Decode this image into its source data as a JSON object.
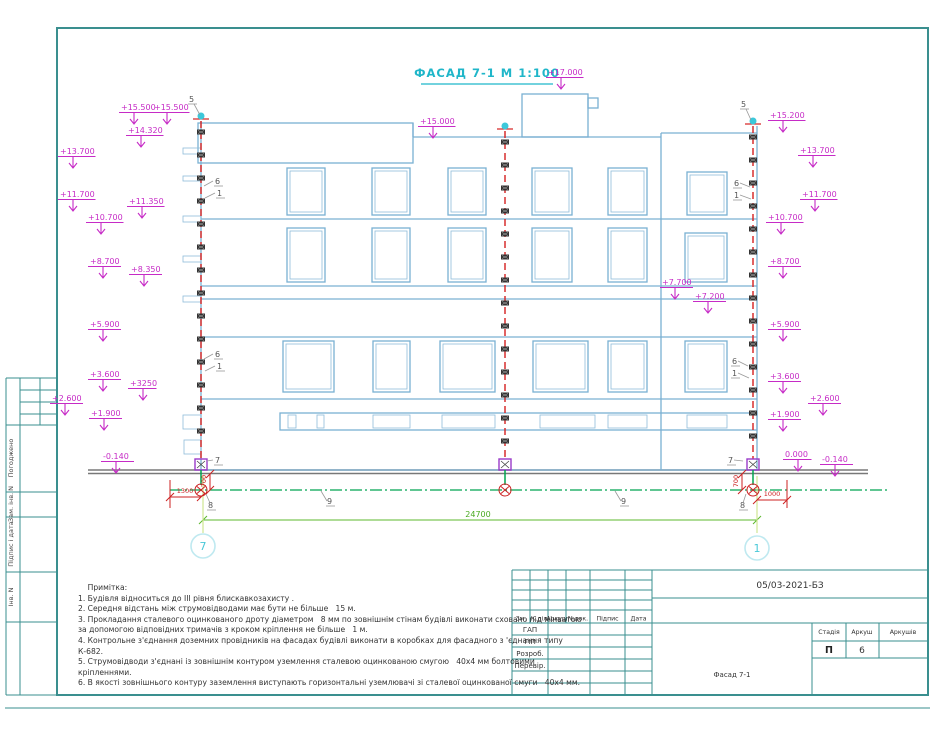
{
  "header": {
    "title": "ФАСАД 7-1  М 1:100"
  },
  "axes": {
    "left": "7",
    "right": "1"
  },
  "dimensions": {
    "total_label": "24700"
  },
  "sheet": {
    "doc_number": "05/03-2021-БЗ",
    "drawing_name": "Фасад 7-1",
    "stage_label": "Стадія",
    "stage_value": "П",
    "sheet_label": "Аркуш",
    "sheet_value": "6",
    "sheets_label": "Аркушів",
    "sheets_value": "",
    "stamp_header": [
      "Зм.",
      "К.діл",
      "Аркуш",
      "№док.",
      "Підпис",
      "Дата"
    ],
    "stamp_rows": [
      "ГАП",
      "ГІП",
      "Розроб.",
      "Перевір."
    ],
    "side_labels": [
      "Погоджено",
      "Зам. інв. N",
      "Підпис і дата",
      "Інв. N"
    ]
  },
  "notes": {
    "lines": [
      "    Примітка:",
      "1. Будівля відноситься до ІІІ рівня блискавкозахисту .",
      "2. Середня відстань між струмовідводами має бути не більше   15 м.",
      "3. Прокладання сталевого оцинкованого дроту діаметром   8 мм по зовнішнім стінам будівлі виконати сховано під мінватою",
      "за допомогою відповідних тримачів з кроком кріплення не більше   1 м.",
      "4. Контрольне з'єднання доземних провідників на фасадах будівлі виконати в коробках для фасадного з 'єднання типу",
      "К-682.",
      "5. Струмовідводи з'єднані із зовнішнім контуром уземлення сталевою оцинкованою смугою   40х4 мм болтовими",
      "кріпленнями.",
      "6. В якості зовнішнього контуру заземлення виступають горизонтальні уземлювачі зі сталевої оцинкованої смуги   40х4 мм."
    ]
  },
  "drawing": {
    "building": {
      "lines": [
        [
          201,
          121,
          201,
          470
        ],
        [
          757,
          126,
          757,
          470
        ],
        [
          413,
          137,
          661,
          137
        ],
        [
          661,
          133,
          757,
          133
        ],
        [
          661,
          133,
          661,
          470
        ],
        [
          201,
          219,
          757,
          219
        ],
        [
          201,
          286,
          757,
          286
        ],
        [
          201,
          299,
          757,
          299
        ],
        [
          201,
          337,
          757,
          337
        ],
        [
          201,
          399,
          757,
          399
        ],
        [
          201,
          470,
          757,
          470
        ],
        [
          413,
          123,
          413,
          137
        ]
      ],
      "rects": [
        [
          198,
          123,
          215,
          40
        ],
        [
          522,
          94,
          66,
          43
        ],
        [
          588,
          98,
          10,
          10
        ],
        [
          280,
          413,
          477,
          17
        ]
      ],
      "stubs": [
        [
          183,
          148,
          18,
          6
        ],
        [
          183,
          176,
          18,
          5
        ],
        [
          183,
          216,
          18,
          6
        ],
        [
          183,
          256,
          18,
          6
        ],
        [
          183,
          296,
          18,
          6
        ],
        [
          183,
          415,
          18,
          14
        ],
        [
          184,
          440,
          17,
          14
        ]
      ]
    },
    "windows": [
      [
        287,
        168,
        38,
        47
      ],
      [
        372,
        168,
        38,
        47
      ],
      [
        448,
        168,
        38,
        47
      ],
      [
        532,
        168,
        40,
        47
      ],
      [
        608,
        168,
        39,
        47
      ],
      [
        687,
        172,
        40,
        43
      ],
      [
        287,
        228,
        38,
        54
      ],
      [
        372,
        228,
        38,
        54
      ],
      [
        448,
        228,
        38,
        54
      ],
      [
        532,
        228,
        40,
        54
      ],
      [
        608,
        228,
        39,
        54
      ],
      [
        685,
        233,
        42,
        49
      ],
      [
        283,
        341,
        51,
        51
      ],
      [
        373,
        341,
        37,
        51
      ],
      [
        440,
        341,
        55,
        51
      ],
      [
        533,
        341,
        55,
        51
      ],
      [
        608,
        341,
        39,
        51
      ],
      [
        685,
        341,
        42,
        51
      ]
    ],
    "strip_windows": [
      [
        288,
        415,
        8,
        13
      ],
      [
        317,
        415,
        7,
        13
      ],
      [
        373,
        415,
        37,
        13
      ],
      [
        442,
        415,
        53,
        13
      ],
      [
        540,
        415,
        55,
        13
      ],
      [
        608,
        415,
        39,
        13
      ],
      [
        687,
        415,
        40,
        13
      ]
    ],
    "conductors": [
      {
        "x": 201,
        "y1": 121
      },
      {
        "x": 505,
        "y1": 131
      },
      {
        "x": 753,
        "y1": 126
      }
    ],
    "elevation_marks": [
      {
        "t": "+15.500",
        "x": 121,
        "y": 103
      },
      {
        "t": "+15.500",
        "x": 154,
        "y": 103
      },
      {
        "t": "+14.320",
        "x": 128,
        "y": 126
      },
      {
        "t": "+13.700",
        "x": 60,
        "y": 147
      },
      {
        "t": "+11.700",
        "x": 60,
        "y": 190
      },
      {
        "t": "+11.350",
        "x": 129,
        "y": 197
      },
      {
        "t": "+10.700",
        "x": 88,
        "y": 213
      },
      {
        "t": "+8.700",
        "x": 90,
        "y": 257
      },
      {
        "t": "+8.350",
        "x": 131,
        "y": 265
      },
      {
        "t": "+5.900",
        "x": 90,
        "y": 320
      },
      {
        "t": "+3.600",
        "x": 90,
        "y": 370
      },
      {
        "t": "+3250",
        "x": 130,
        "y": 379
      },
      {
        "t": "+2.600",
        "x": 52,
        "y": 394
      },
      {
        "t": "+1.900",
        "x": 91,
        "y": 409
      },
      {
        "t": "-0.140",
        "x": 103,
        "y": 452
      },
      {
        "t": "+17.000",
        "x": 548,
        "y": 68
      },
      {
        "t": "+15.000",
        "x": 420,
        "y": 117
      },
      {
        "t": "+7.700",
        "x": 662,
        "y": 278
      },
      {
        "t": "+7.200",
        "x": 695,
        "y": 292
      },
      {
        "t": "+15.200",
        "x": 770,
        "y": 111
      },
      {
        "t": "+13.700",
        "x": 800,
        "y": 146
      },
      {
        "t": "+11.700",
        "x": 802,
        "y": 190
      },
      {
        "t": "+10.700",
        "x": 768,
        "y": 213
      },
      {
        "t": "+8.700",
        "x": 770,
        "y": 257
      },
      {
        "t": "+5.900",
        "x": 770,
        "y": 320
      },
      {
        "t": "+3.600",
        "x": 770,
        "y": 372
      },
      {
        "t": "+2.600",
        "x": 810,
        "y": 394
      },
      {
        "t": "+1.900",
        "x": 770,
        "y": 410
      },
      {
        "t": "0.000",
        "x": 785,
        "y": 450
      },
      {
        "t": "-0.140",
        "x": 822,
        "y": 455
      }
    ],
    "labels": [
      {
        "t": "5",
        "x": 189,
        "y": 102,
        "l": [
          194,
          104,
          200,
          115
        ]
      },
      {
        "t": "5",
        "x": 741,
        "y": 107,
        "l": [
          746,
          109,
          751,
          120
        ]
      },
      {
        "t": "6",
        "x": 215,
        "y": 184,
        "l": [
          213,
          181,
          204,
          186
        ]
      },
      {
        "t": "1",
        "x": 217,
        "y": 196,
        "l": [
          215,
          193,
          205,
          198
        ]
      },
      {
        "t": "6",
        "x": 215,
        "y": 357,
        "l": [
          213,
          354,
          204,
          359
        ]
      },
      {
        "t": "1",
        "x": 217,
        "y": 369,
        "l": [
          215,
          366,
          205,
          371
        ]
      },
      {
        "t": "6",
        "x": 734,
        "y": 186,
        "l": [
          740,
          183,
          750,
          187
        ]
      },
      {
        "t": "1",
        "x": 734,
        "y": 198,
        "l": [
          740,
          195,
          751,
          199
        ]
      },
      {
        "t": "6",
        "x": 732,
        "y": 364,
        "l": [
          738,
          361,
          748,
          366
        ]
      },
      {
        "t": "1",
        "x": 732,
        "y": 376,
        "l": [
          738,
          373,
          749,
          378
        ]
      },
      {
        "t": "7",
        "x": 215,
        "y": 463,
        "l": [
          213,
          460,
          207,
          461
        ]
      },
      {
        "t": "7",
        "x": 728,
        "y": 463,
        "l": [
          734,
          460,
          743,
          461
        ]
      },
      {
        "t": "8",
        "x": 208,
        "y": 508,
        "l": [
          206,
          494,
          210,
          503
        ]
      },
      {
        "t": "8",
        "x": 740,
        "y": 508,
        "l": [
          746,
          494,
          743,
          503
        ]
      },
      {
        "t": "9",
        "x": 327,
        "y": 504,
        "l": [
          321,
          491,
          327,
          501
        ]
      },
      {
        "t": "9",
        "x": 621,
        "y": 504,
        "l": [
          615,
          491,
          621,
          501
        ]
      }
    ],
    "red_path": "M170 480 V508 M170 497 H201 M210 474 V490 M742 474 V490 M787 480 V508 M757 500 H787 M166 501 L174 493 M197 501 L205 493 M753 504 L761 496 M783 504 L791 496 M206 478 L214 470 M206 494 L214 486 M738 478 L746 470 M738 494 L746 486",
    "red_texts": [
      {
        "t": "1300",
        "x": 185,
        "y": 493,
        "r": 0
      },
      {
        "t": "1000",
        "x": 772,
        "y": 496,
        "r": 0
      },
      {
        "t": "700",
        "x": 206,
        "y": 481,
        "r": -90
      },
      {
        "t": "700",
        "x": 738,
        "y": 481,
        "r": -90
      }
    ]
  }
}
